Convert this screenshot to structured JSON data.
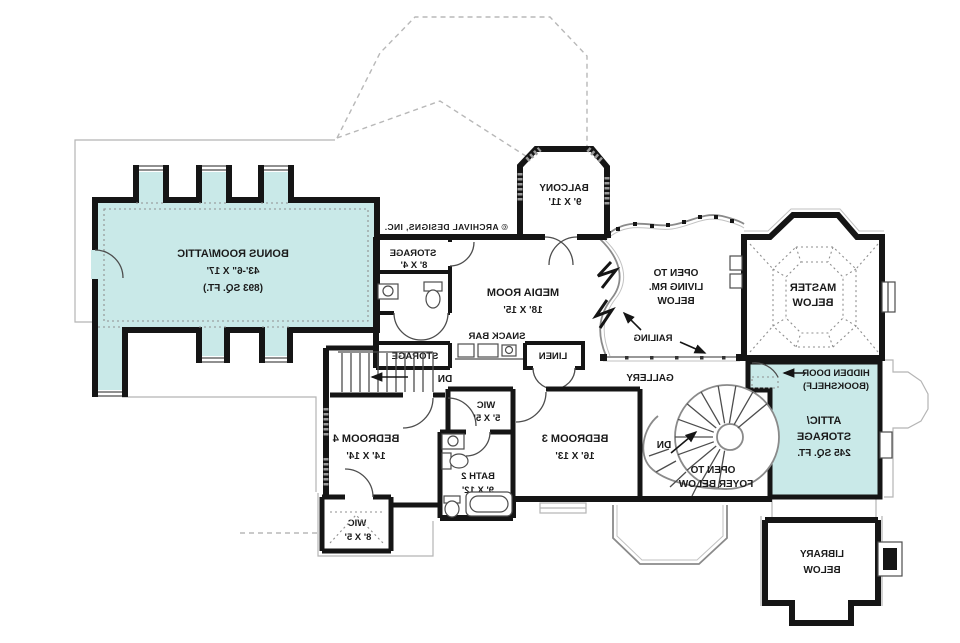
{
  "credit": "© ARCHIVAL DESIGNS, INC.",
  "colors": {
    "highlight": "#c9e9e8",
    "wall": "#151515",
    "rail_gray": "#8a8a8a",
    "roof_dash": "#b8b8b8"
  },
  "stairs": {
    "down_label": "DN"
  },
  "rooms": {
    "bonus": {
      "lines": [
        "BONUS ROOM/ATTIC",
        "43'-6\" X 17'",
        "(893 SQ. FT.)"
      ]
    },
    "storage_upper": {
      "lines": [
        "STORAGE",
        "8' X 4'"
      ]
    },
    "media": {
      "lines": [
        "MEDIA ROOM",
        "18' X 15'"
      ]
    },
    "balcony": {
      "lines": [
        "BALCONY",
        "9' X 11'"
      ]
    },
    "open_living": {
      "lines": [
        "OPEN TO",
        "LIVING RM.",
        "BELOW"
      ]
    },
    "master": {
      "lines": [
        "MASTER",
        "BELOW"
      ]
    },
    "railing": {
      "label": "RAILING"
    },
    "gallery": {
      "label": "GALLERY"
    },
    "hidden_door": {
      "lines": [
        "HIDDEN DOOR",
        "(BOOKSHELF)"
      ]
    },
    "attic_storage": {
      "lines": [
        "ATTIC/",
        "STORAGE",
        "245 SQ. FT."
      ]
    },
    "open_foyer": {
      "lines": [
        "OPEN TO",
        "FOYER BELOW"
      ]
    },
    "library": {
      "lines": [
        "LIBRARY",
        "BELOW"
      ]
    },
    "snack_bar": {
      "label": "SNACK BAR"
    },
    "linen": {
      "label": "LINEN"
    },
    "storage_hall": {
      "label": "STORAGE"
    },
    "bedroom4": {
      "lines": [
        "BEDROOM 4",
        "14' X 14'"
      ]
    },
    "bedroom3": {
      "lines": [
        "BEDROOM 3",
        "16' X 13'"
      ]
    },
    "wic_small": {
      "lines": [
        "WIC",
        "5' X 5'"
      ]
    },
    "bath2": {
      "lines": [
        "BATH 2",
        "9' X 12'"
      ]
    },
    "wic_bedroom4": {
      "lines": [
        "WIC",
        "8' X 5'"
      ]
    }
  }
}
